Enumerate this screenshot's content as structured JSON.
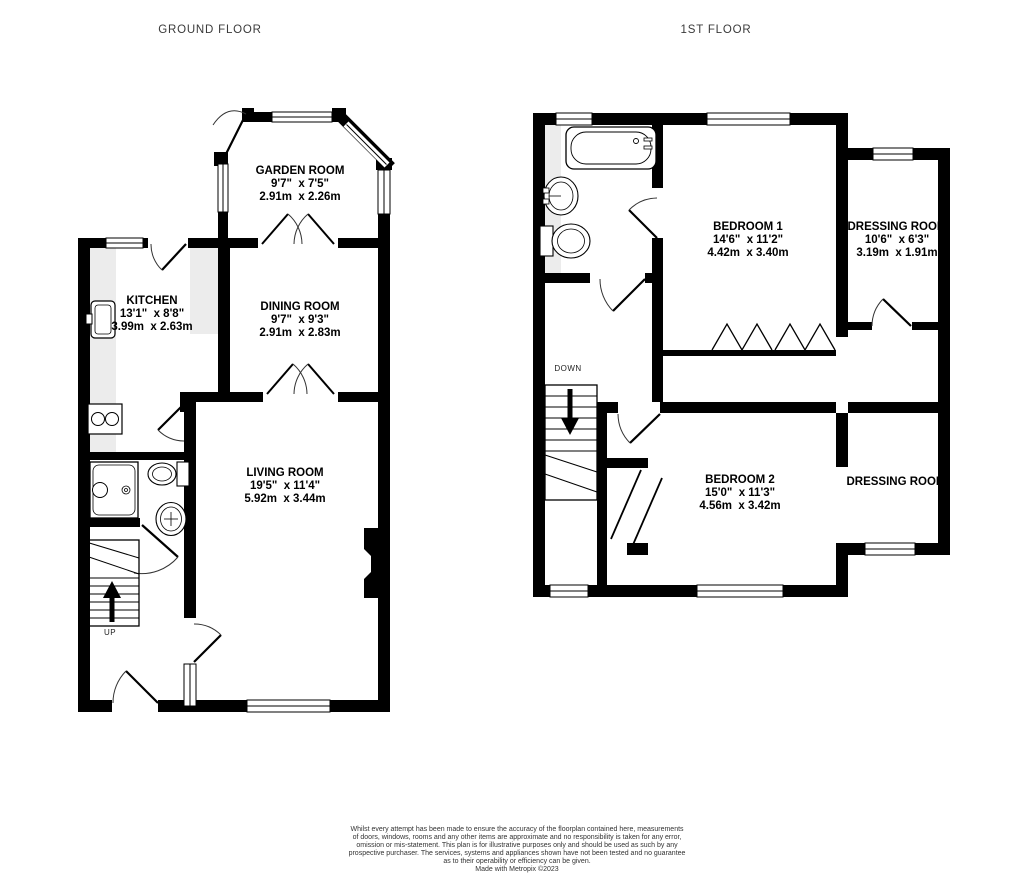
{
  "ground_floor": {
    "title": "GROUND FLOOR",
    "stairs_label": "UP",
    "rooms": {
      "garden_room": {
        "name": "GARDEN ROOM",
        "imperial": "9'7\"  x 7'5\"",
        "metric": "2.91m  x 2.26m"
      },
      "kitchen": {
        "name": "KITCHEN",
        "imperial": "13'1\"  x 8'8\"",
        "metric": "3.99m  x 2.63m"
      },
      "dining_room": {
        "name": "DINING ROOM",
        "imperial": "9'7\"  x 9'3\"",
        "metric": "2.91m  x 2.83m"
      },
      "living_room": {
        "name": "LIVING ROOM",
        "imperial": "19'5\"  x 11'4\"",
        "metric": "5.92m  x 3.44m"
      }
    }
  },
  "first_floor": {
    "title": "1ST FLOOR",
    "stairs_label": "DOWN",
    "rooms": {
      "bedroom_1": {
        "name": "BEDROOM 1",
        "imperial": "14'6\"  x 11'2\"",
        "metric": "4.42m  x 3.40m"
      },
      "dressing_room_1": {
        "name": "DRESSING ROOM",
        "imperial": "10'6\"  x 6'3\"",
        "metric": "3.19m  x 1.91m"
      },
      "bedroom_2": {
        "name": "BEDROOM 2",
        "imperial": "15'0\"  x 11'3\"",
        "metric": "4.56m  x 3.42m"
      },
      "dressing_room_2": {
        "name": "DRESSING ROOM"
      }
    }
  },
  "footer": {
    "lines": [
      "Whilst every attempt has been made to ensure the accuracy of the floorplan contained here, measurements",
      "of doors, windows, rooms and any other items are approximate and no responsibility is taken for any error,",
      "omission or mis-statement. This plan is for illustrative purposes only and should be used as such by any",
      "prospective purchaser. The services, systems and appliances shown have not been tested and no guarantee",
      "as to their operability or efficiency can be given."
    ],
    "credit": "Made with Metropix ©2023"
  },
  "colors": {
    "wall": "#000000",
    "counter": "#ececec",
    "background": "#ffffff"
  }
}
